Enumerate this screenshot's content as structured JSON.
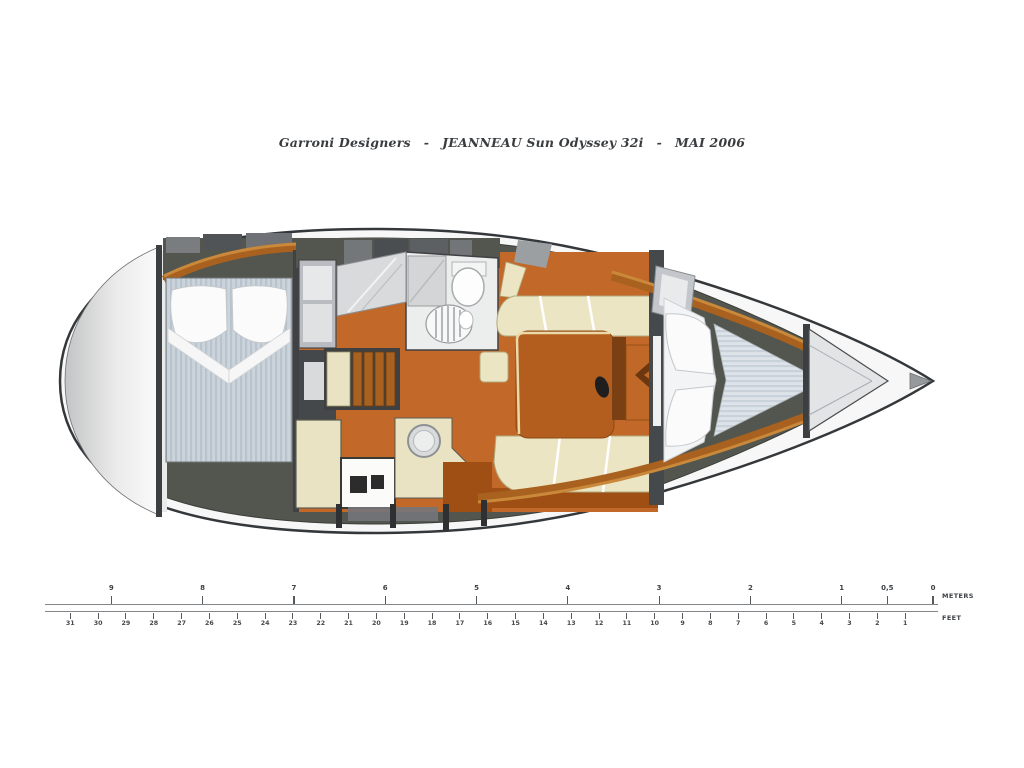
{
  "title": {
    "designer": "Garroni Designers",
    "separator": "-",
    "model": "JEANNEAU Sun Odyssey 32i",
    "date": "MAI 2006"
  },
  "scale": {
    "meters_label": "METERS",
    "feet_label": "FEET",
    "meters": [
      {
        "value": 9,
        "label": "9"
      },
      {
        "value": 8,
        "label": "8"
      },
      {
        "value": 7,
        "label": "7"
      },
      {
        "value": 6,
        "label": "6"
      },
      {
        "value": 5,
        "label": "5"
      },
      {
        "value": 4,
        "label": "4"
      },
      {
        "value": 3,
        "label": "3"
      },
      {
        "value": 2,
        "label": "2"
      },
      {
        "value": 1,
        "label": "1"
      },
      {
        "value": 0.5,
        "label": "0,5"
      },
      {
        "value": 0,
        "label": "0"
      }
    ],
    "feet": [
      {
        "value": 31,
        "label": "31"
      },
      {
        "value": 30,
        "label": "30"
      },
      {
        "value": 29,
        "label": "29"
      },
      {
        "value": 28,
        "label": "28"
      },
      {
        "value": 27,
        "label": "27"
      },
      {
        "value": 26,
        "label": "26"
      },
      {
        "value": 25,
        "label": "25"
      },
      {
        "value": 24,
        "label": "24"
      },
      {
        "value": 23,
        "label": "23"
      },
      {
        "value": 22,
        "label": "22"
      },
      {
        "value": 21,
        "label": "21"
      },
      {
        "value": 20,
        "label": "20"
      },
      {
        "value": 19,
        "label": "19"
      },
      {
        "value": 18,
        "label": "18"
      },
      {
        "value": 17,
        "label": "17"
      },
      {
        "value": 16,
        "label": "16"
      },
      {
        "value": 15,
        "label": "15"
      },
      {
        "value": 14,
        "label": "14"
      },
      {
        "value": 13,
        "label": "13"
      },
      {
        "value": 12,
        "label": "12"
      },
      {
        "value": 11,
        "label": "11"
      },
      {
        "value": 10,
        "label": "10"
      },
      {
        "value": 9,
        "label": "9"
      },
      {
        "value": 8,
        "label": "8"
      },
      {
        "value": 7,
        "label": "7"
      },
      {
        "value": 6,
        "label": "6"
      },
      {
        "value": 5,
        "label": "5"
      },
      {
        "value": 4,
        "label": "4"
      },
      {
        "value": 3,
        "label": "3"
      },
      {
        "value": 2,
        "label": "2"
      },
      {
        "value": 1,
        "label": "1"
      }
    ]
  },
  "palette": {
    "hull_outline": "#35383b",
    "deck_gray": "#53564e",
    "floor_orange": "#c2692a",
    "floor_dark_orange": "#a04f14",
    "wood_trim": "#a8611f",
    "wood_trim_light": "#c9883a",
    "settee_cream": "#ece5c3",
    "galley_cream": "#e9e3c4",
    "table_brown": "#b35e1e",
    "table_dark": "#7a3f12",
    "table_leaf": "#bf6827",
    "mattress_stripe_a": "#ccd4db",
    "mattress_stripe_b": "#b9c3cd",
    "vberth_stripe_a": "#dde3e9",
    "vberth_stripe_b": "#c9d2da"
  }
}
